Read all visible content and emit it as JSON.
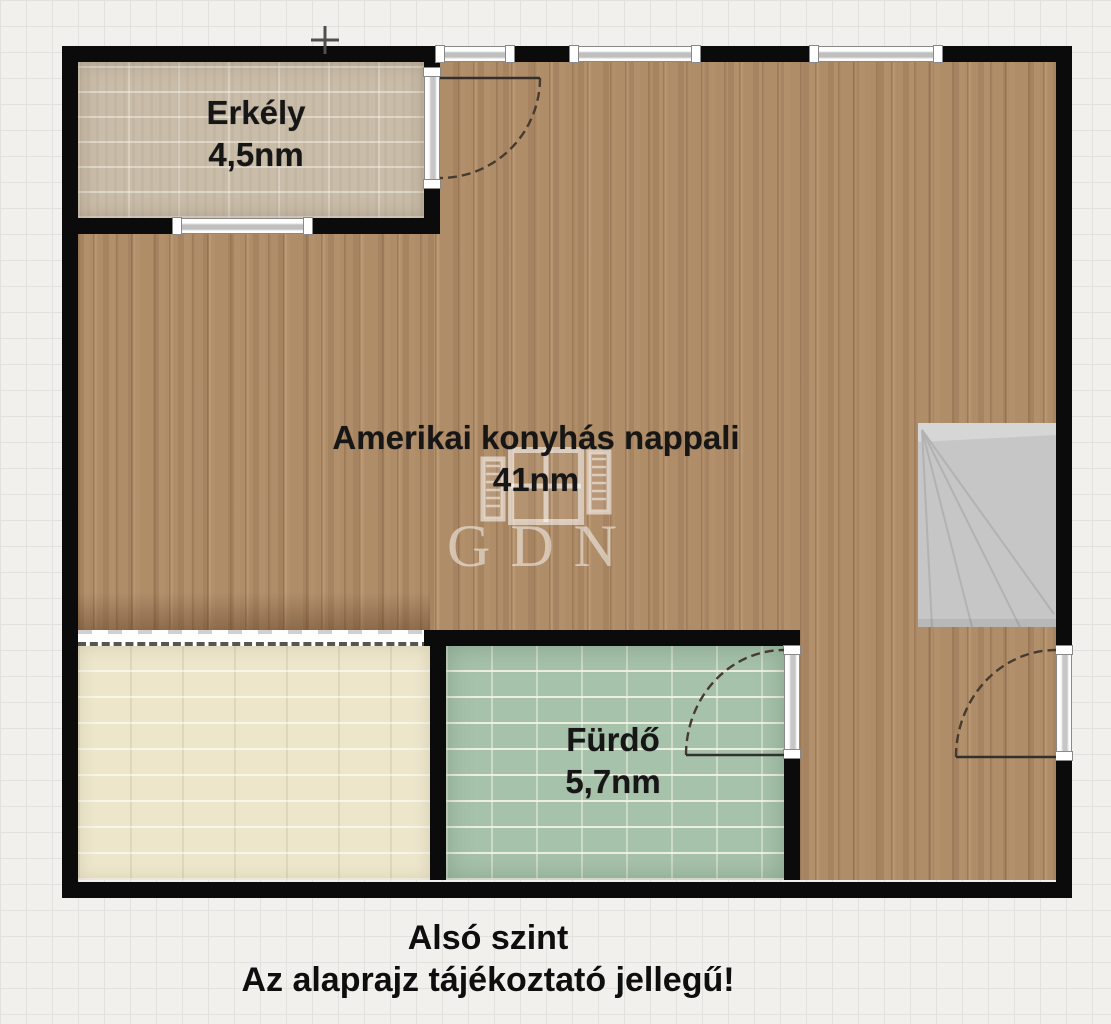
{
  "rooms": {
    "balcony": {
      "name": "Erkély",
      "area": "4,5nm"
    },
    "living": {
      "name": "Amerikai konyhás nappali",
      "area": "41nm"
    },
    "bathroom": {
      "name": "Fürdő",
      "area": "5,7nm"
    }
  },
  "footer": {
    "level": "Alsó szint",
    "disclaimer": "Az alaprajz tájékoztató jellegű!"
  },
  "watermark": {
    "brand": "GDN"
  },
  "colors": {
    "wall": "#0b0b0b",
    "wood_floor": "#b08d69",
    "balcony_floor": "#c9bca8",
    "bathroom_floor": "#a7c2ab",
    "lower_room_floor": "#ede6cb",
    "stairs": "#c6c6c6",
    "background_grid": "#f1f0ed"
  }
}
